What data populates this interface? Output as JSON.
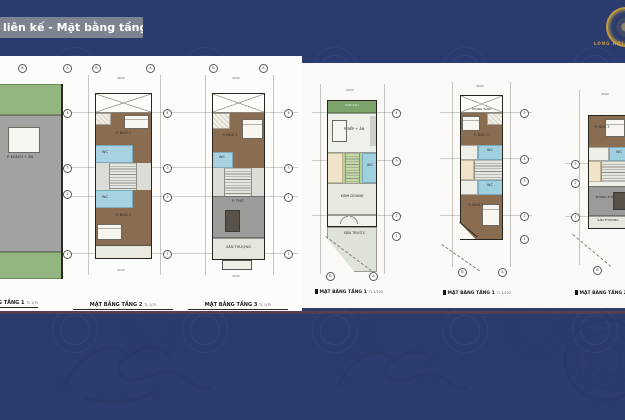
{
  "header": {
    "title": "liên kế - Mặt bằng tầng",
    "brand": "LONG HỘI",
    "emblem_icon": "gold-dragon-seal"
  },
  "colors": {
    "background": "#2c3b6d",
    "panel": "#fcfcfa",
    "title_bar": "#858b92",
    "brand_gold": "#c49a3c",
    "wood_floor": "#8a6d50",
    "wet_room": "#a7d2e2",
    "garden_green": "#93b580",
    "dark_green": "#7da36a",
    "slab_gray": "#a2a2a0",
    "light_floor": "#e8e8e1"
  },
  "axis": {
    "h": [
      "B",
      "A"
    ],
    "v": [
      "1",
      "2",
      "3",
      "4",
      "5"
    ]
  },
  "plans": [
    {
      "caption": "MẶT BẰNG TẦNG 1",
      "scale": "TL 1/75",
      "rooms": {
        "living": "P. KHÁCH + ĂN"
      },
      "dims": {
        "top": "4800",
        "bottom": "4200"
      }
    },
    {
      "caption": "MẶT BẰNG TẦNG 2",
      "scale": "TL 1/75",
      "rooms": {
        "bed1": "P. NGỦ 1",
        "wc1": "WC",
        "wc2": "WC",
        "bed2": "P. NGỦ 2"
      },
      "dims": {
        "top": "4800",
        "bottom": "4200"
      }
    },
    {
      "caption": "MẶT BẰNG TẦNG 3",
      "scale": "TL 1/75",
      "rooms": {
        "bed3": "P. NGỦ 3",
        "wc": "WC",
        "worship": "P. THỜ",
        "terrace": "SÂN THƯỢNG"
      },
      "dims": {
        "top": "4000",
        "bottom": "4200"
      }
    },
    {
      "caption": "MẶT BẰNG TẦNG 1",
      "scale": "TL 1/100",
      "rooms": {
        "backyard": "SÂN SAU",
        "kitchen": "P. BẾP + ĂN",
        "wc": "WC",
        "business": "KINH DOANH",
        "frontyard": "SÂN TRƯỚC"
      },
      "dims": {
        "top": "4000"
      }
    },
    {
      "caption": "MẶT BẰNG TẦNG 1",
      "scale": "TL 1/100",
      "rooms": {
        "void": "THÔNG TẦNG",
        "bed1": "P. NGỦ 1",
        "wc1": "WC",
        "wc2": "WC",
        "bed2": "P. NGỦ 2"
      },
      "dims": {
        "top": "4000"
      }
    },
    {
      "caption": "MẶT BẰNG TẦNG 2",
      "scale": "TL 1/100",
      "rooms": {
        "bed3": "P. NGỦ 3",
        "wc": "WC",
        "worship": "PHÒNG THỜ",
        "terrace": "SÂN THƯỢNG"
      },
      "dims": {
        "top": "4000"
      }
    }
  ]
}
